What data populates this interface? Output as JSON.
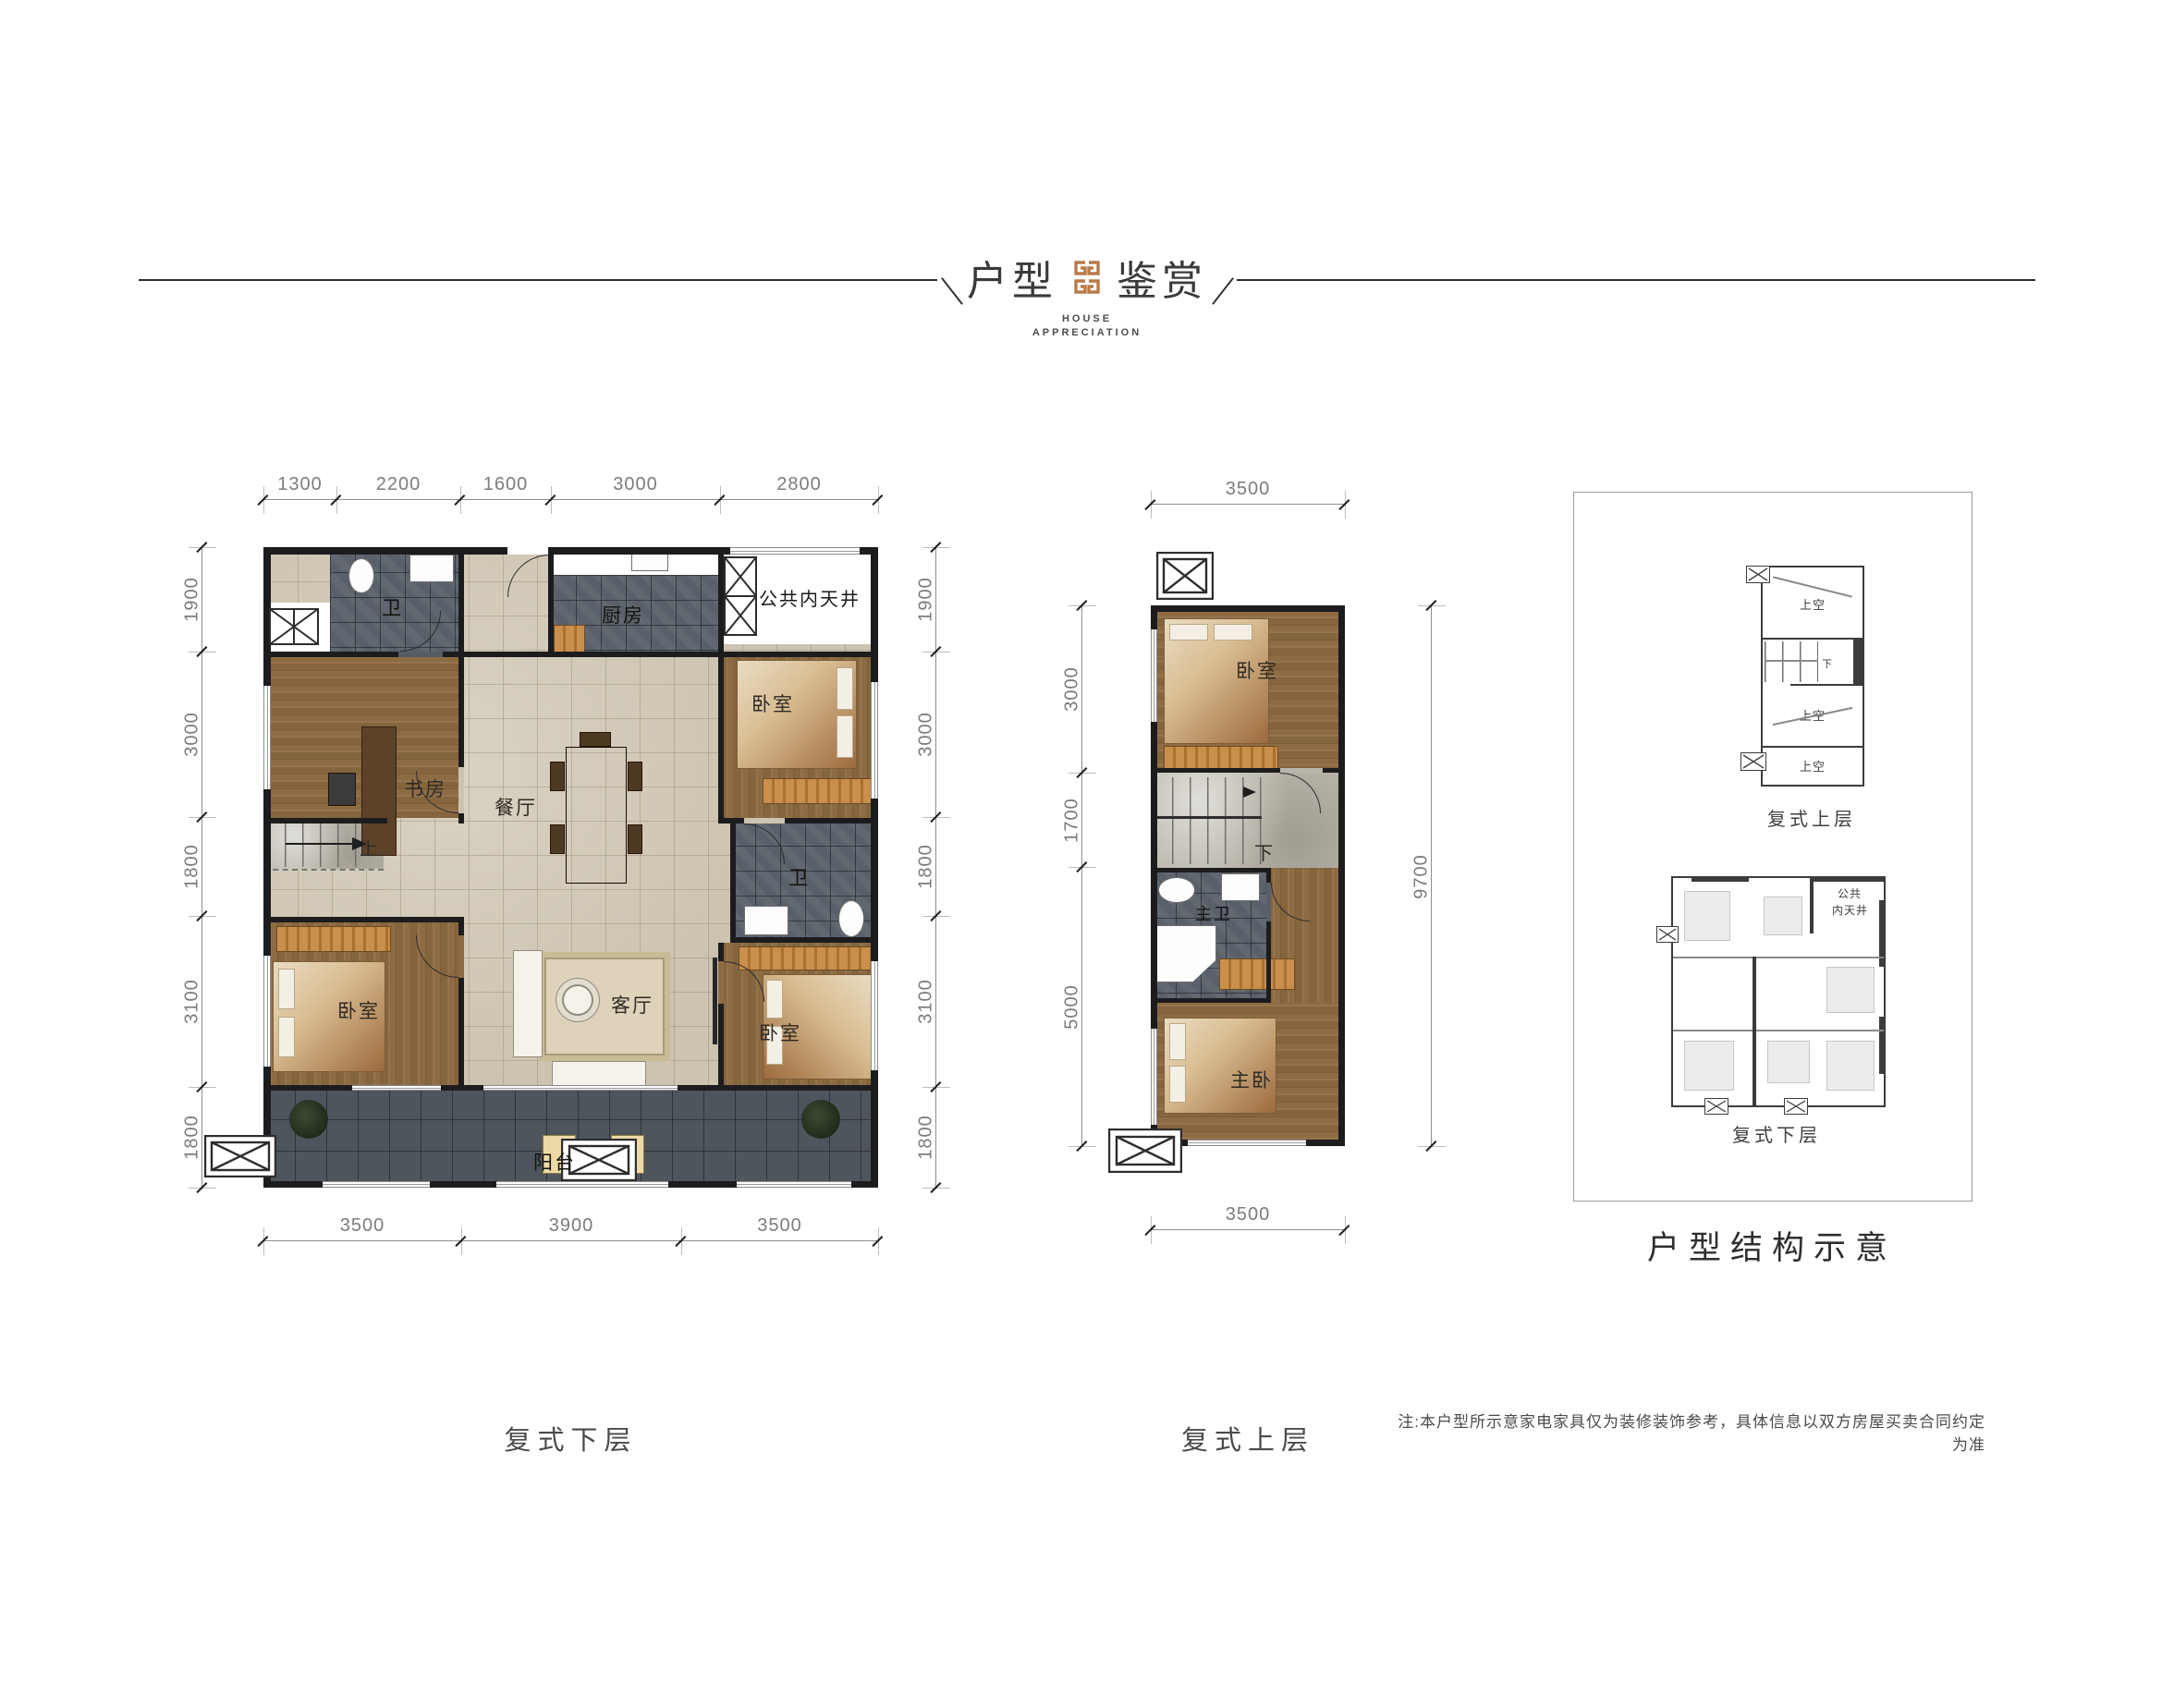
{
  "header": {
    "title_left": "户型",
    "title_right": "鉴赏",
    "subtitle_line1": "HOUSE",
    "subtitle_line2": "APPRECIATION",
    "logo_color": "#b97a4a"
  },
  "plans": {
    "lower": {
      "caption": "复式下层",
      "rooms": {
        "bath1": "卫",
        "kitchen": "厨房",
        "courtyard": "公共内天井",
        "study": "书房",
        "dining": "餐厅",
        "bedroom_tr": "卧室",
        "stairs_up": "上",
        "bath2": "卫",
        "bedroom_bl": "卧室",
        "living": "客厅",
        "bedroom_br": "卧室",
        "balcony": "阳台"
      },
      "dims": {
        "top": [
          "1300",
          "2200",
          "1600",
          "3000",
          "2800"
        ],
        "bottom": [
          "3500",
          "3900",
          "3500"
        ],
        "left": [
          "1900",
          "3000",
          "1800",
          "3100",
          "1800"
        ],
        "right": [
          "1900",
          "3000",
          "1800",
          "3100",
          "1800"
        ]
      }
    },
    "upper": {
      "caption": "复式上层",
      "rooms": {
        "bedroom": "卧室",
        "stairs_down": "下",
        "master_bath": "主卫",
        "master_bedroom": "主卧"
      },
      "dims": {
        "top": [
          "3500"
        ],
        "bottom": [
          "3500"
        ],
        "left": [
          "3000",
          "1700",
          "5000"
        ],
        "right": [
          "9700"
        ]
      }
    }
  },
  "structure_panel": {
    "caption": "户型结构示意",
    "upper_label": "复式上层",
    "lower_label": "复式下层",
    "void_labels": [
      "上空",
      "上空",
      "上空"
    ],
    "stairs_down": "下",
    "courtyard_line1": "公共",
    "courtyard_line2": "内天井"
  },
  "note": "注:本户型所示意家电家具仅为装修装饰参考，具体信息以双方房屋买卖合同约定为准"
}
